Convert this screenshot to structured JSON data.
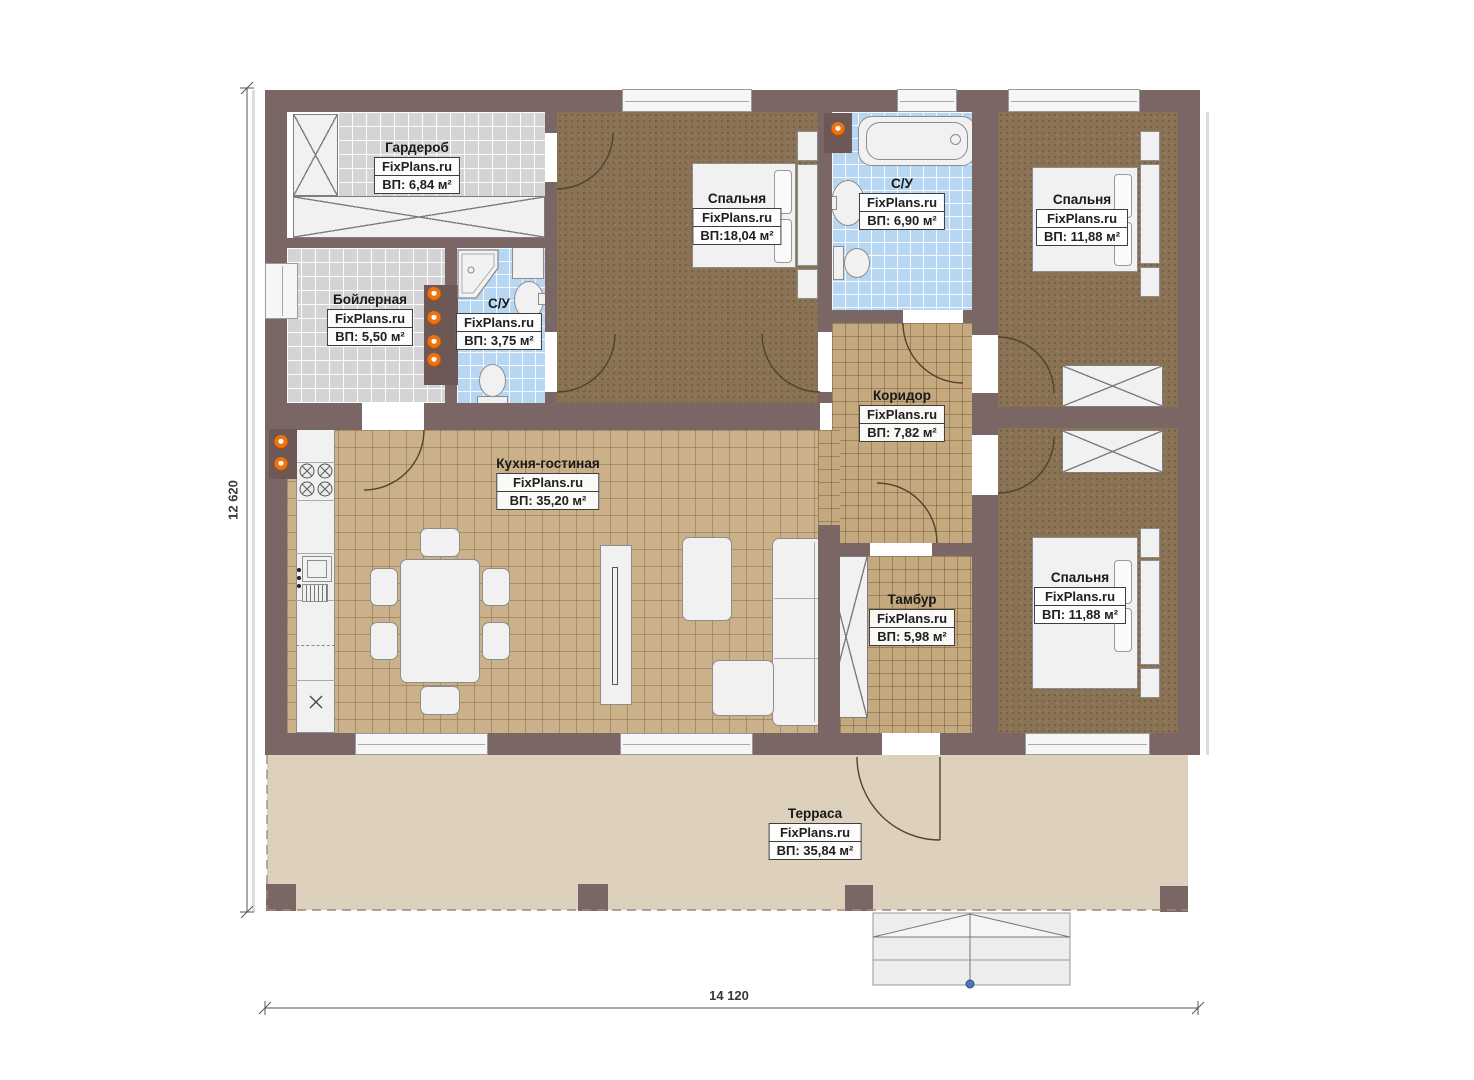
{
  "brand": "FixPlans.ru",
  "rooms": [
    {
      "name": "Гардероб",
      "area": "ВП: 6,84 м²"
    },
    {
      "name": "Бойлерная",
      "area": "ВП: 5,50 м²"
    },
    {
      "name": "С/У",
      "area": "ВП: 3,75 м²"
    },
    {
      "name": "Спальня",
      "area": "ВП:18,04 м²"
    },
    {
      "name": "С/У",
      "area": "ВП: 6,90 м²"
    },
    {
      "name": "Спальня",
      "area": "ВП: 11,88 м²"
    },
    {
      "name": "Коридор",
      "area": "ВП: 7,82 м²"
    },
    {
      "name": "Кухня-гостиная",
      "area": "ВП: 35,20 м²"
    },
    {
      "name": "Тамбур",
      "area": "ВП: 5,98 м²"
    },
    {
      "name": "Спальня",
      "area": "ВП: 11,88 м²"
    },
    {
      "name": "Терраса",
      "area": "ВП: 35,84 м²"
    }
  ],
  "dimensions": {
    "width": "14 120",
    "height": "12 620"
  },
  "colors": {
    "wall": "#7a6665",
    "terrace_floor": "#ddd0bc",
    "bathroom_tile": "#b7d6f2",
    "kitchen_tile": "#cab18a",
    "hall_tile": "#c4a97f",
    "bedroom_floor": "#8a7254",
    "utility_tile": "#d4d4d7",
    "marker_orange": "#ef7210",
    "stair_marker_blue": "#4f76bd"
  }
}
